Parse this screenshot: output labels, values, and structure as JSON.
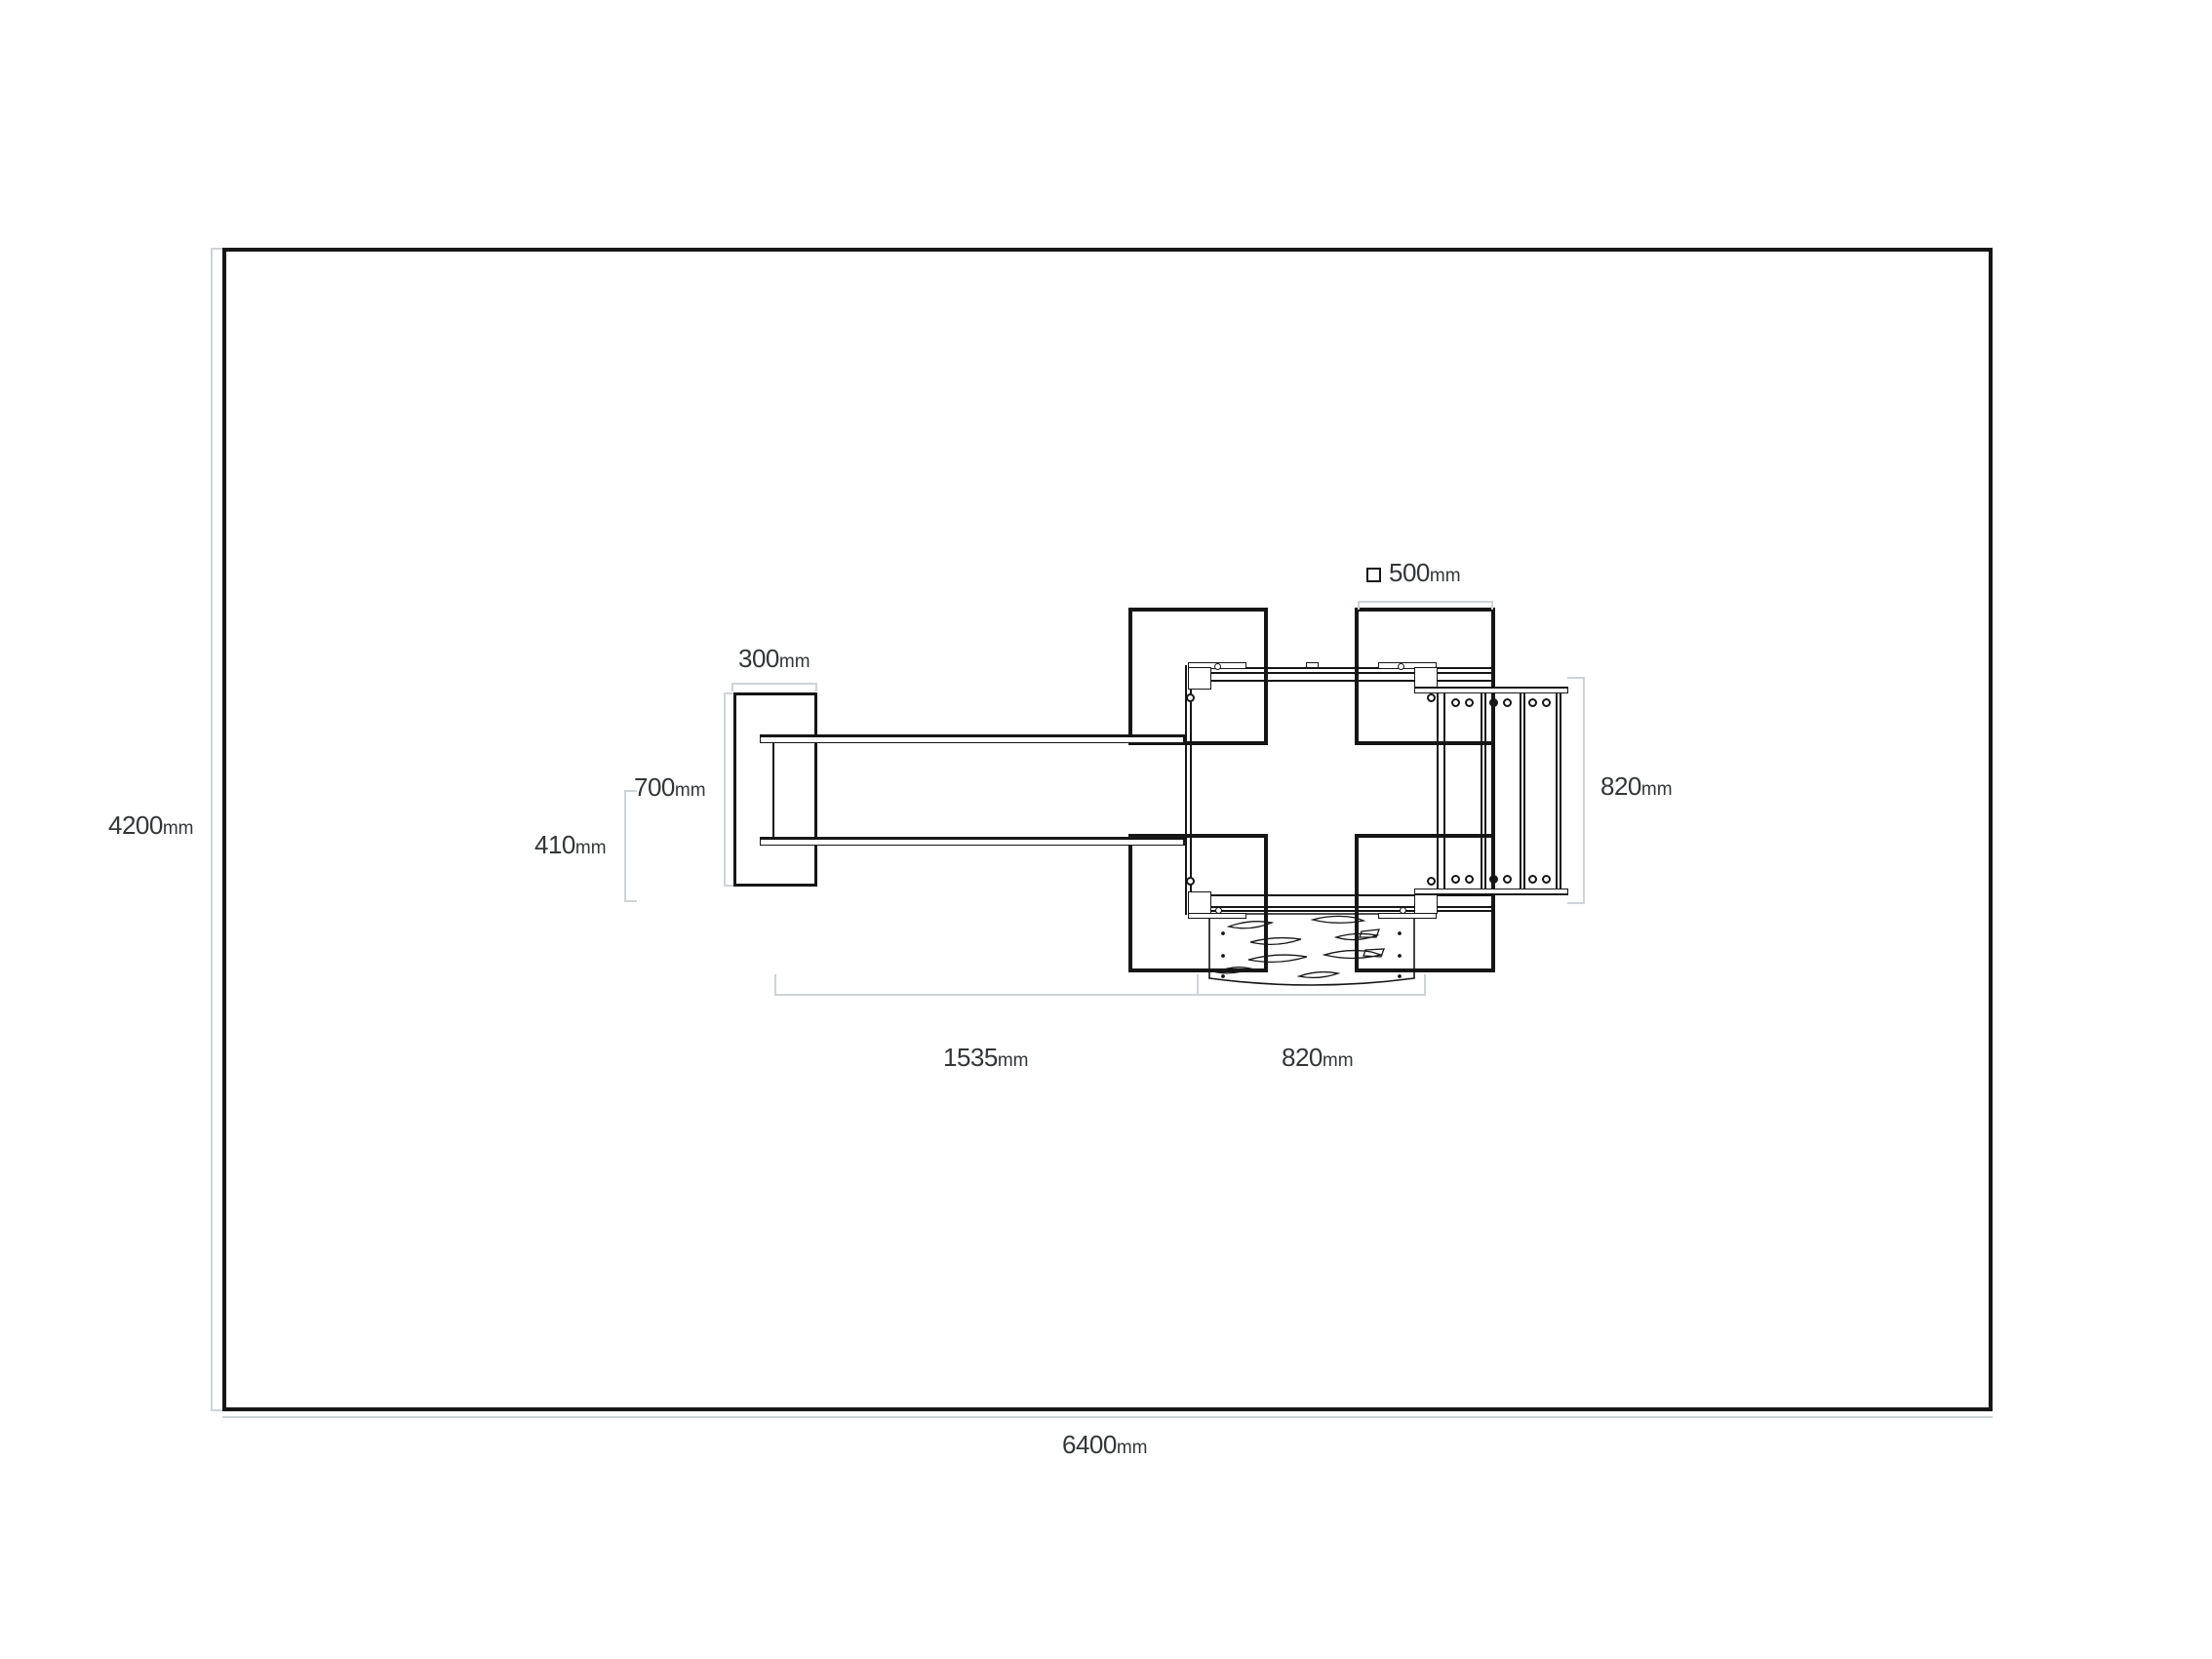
{
  "colors": {
    "drawing_line": "#161616",
    "dimension_line": "#ced3d6",
    "label_text": "#333638",
    "background": "#ffffff"
  },
  "dims": {
    "room_height": {
      "value": "4200",
      "unit": "mm"
    },
    "room_width": {
      "value": "6400",
      "unit": "mm"
    },
    "mast_width": {
      "value": "300",
      "unit": "mm"
    },
    "mast_height": {
      "value": "700",
      "unit": "mm"
    },
    "fork_spacing": {
      "value": "410",
      "unit": "mm"
    },
    "fork_reach": {
      "value": "1535",
      "unit": "mm"
    },
    "pallet_width": {
      "value": "820",
      "unit": "mm"
    },
    "post_section": {
      "value": "500",
      "unit": "mm",
      "symbol": "square"
    },
    "side_depth": {
      "value": "820",
      "unit": "mm"
    }
  }
}
